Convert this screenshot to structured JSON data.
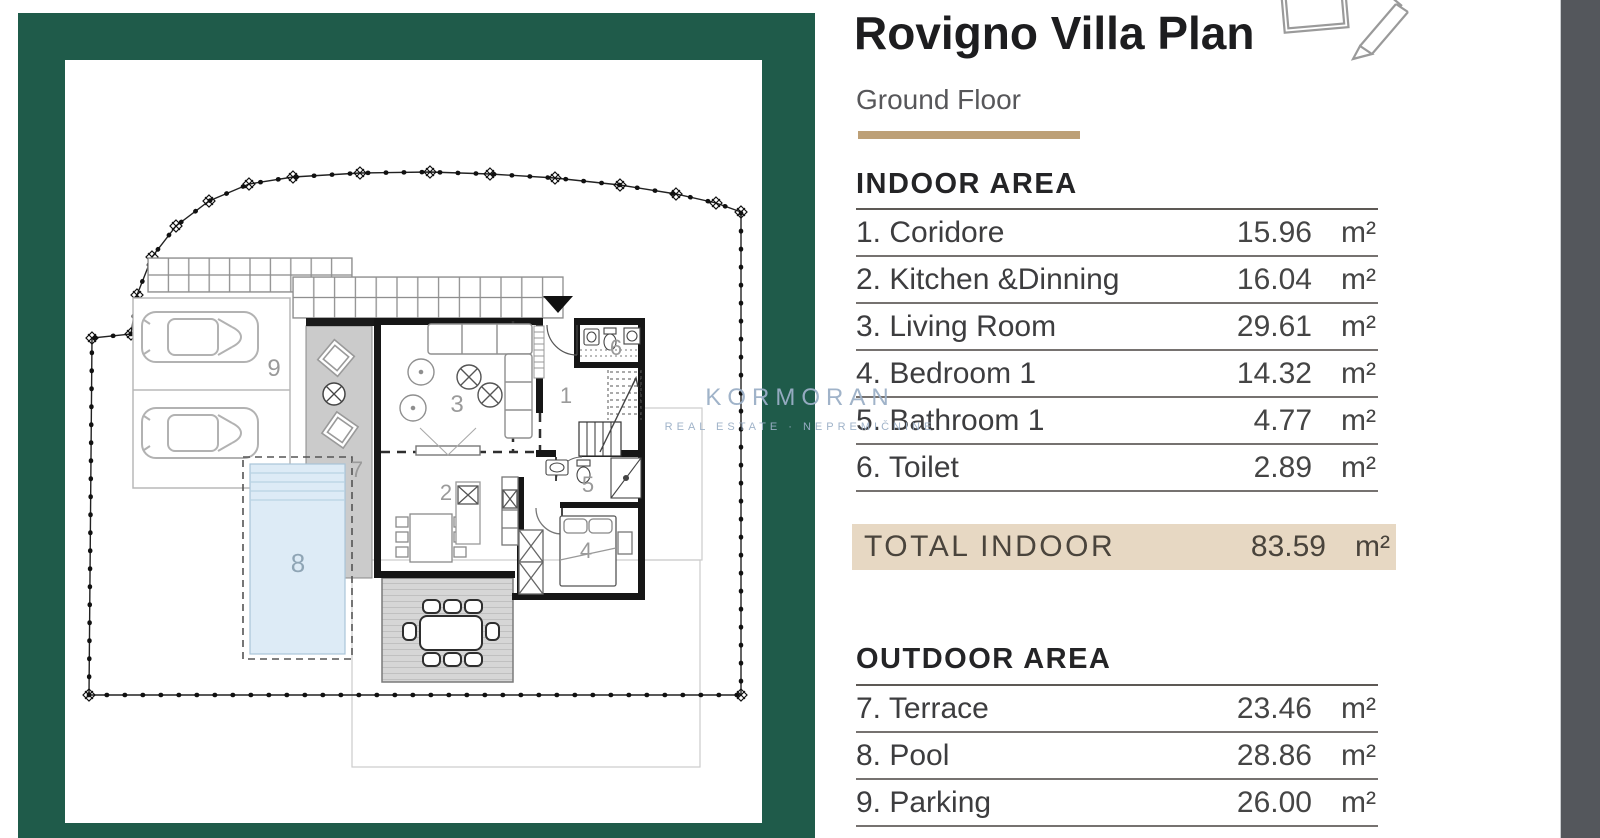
{
  "panel": {
    "title": "Rovigno Villa Plan",
    "subtitle": "Ground Floor",
    "indoor": {
      "heading": "INDOOR AREA",
      "rows": [
        {
          "label": "1. Coridore",
          "value": "15.96",
          "unit": "m²"
        },
        {
          "label": "2. Kitchen &Dinning",
          "value": "16.04",
          "unit": "m²"
        },
        {
          "label": "3. Living Room",
          "value": "29.61",
          "unit": "m²"
        },
        {
          "label": "4. Bedroom 1",
          "value": "14.32",
          "unit": "m²"
        },
        {
          "label": "5. Bathroom 1",
          "value": "4.77",
          "unit": "m²"
        },
        {
          "label": "6. Toilet",
          "value": "2.89",
          "unit": "m²"
        }
      ],
      "total": {
        "label": "TOTAL INDOOR",
        "value": "83.59",
        "unit": "m²"
      }
    },
    "outdoor": {
      "heading": "OUTDOOR AREA",
      "rows": [
        {
          "label": "7. Terrace",
          "value": "23.46",
          "unit": "m²"
        },
        {
          "label": "8. Pool",
          "value": "28.86",
          "unit": "m²"
        },
        {
          "label": "9. Parking",
          "value": "26.00",
          "unit": "m²"
        }
      ]
    }
  },
  "plan": {
    "room_numbers": {
      "corridor": "1",
      "kitchen": "2",
      "living": "3",
      "bedroom": "4",
      "bathroom": "5",
      "toilet": "6",
      "terrace": "7",
      "pool": "8",
      "parking": "9"
    },
    "watermark": {
      "brand": "KORMORAN",
      "tagline": "REAL ESTATE · NEPREMIČNINE"
    }
  },
  "colors": {
    "frame_green": "#1f5b4a",
    "accent_tan": "#bda077",
    "total_highlight": "#e7d8c3",
    "side_strip": "#54575c",
    "pool_fill": "#ddebf6"
  }
}
